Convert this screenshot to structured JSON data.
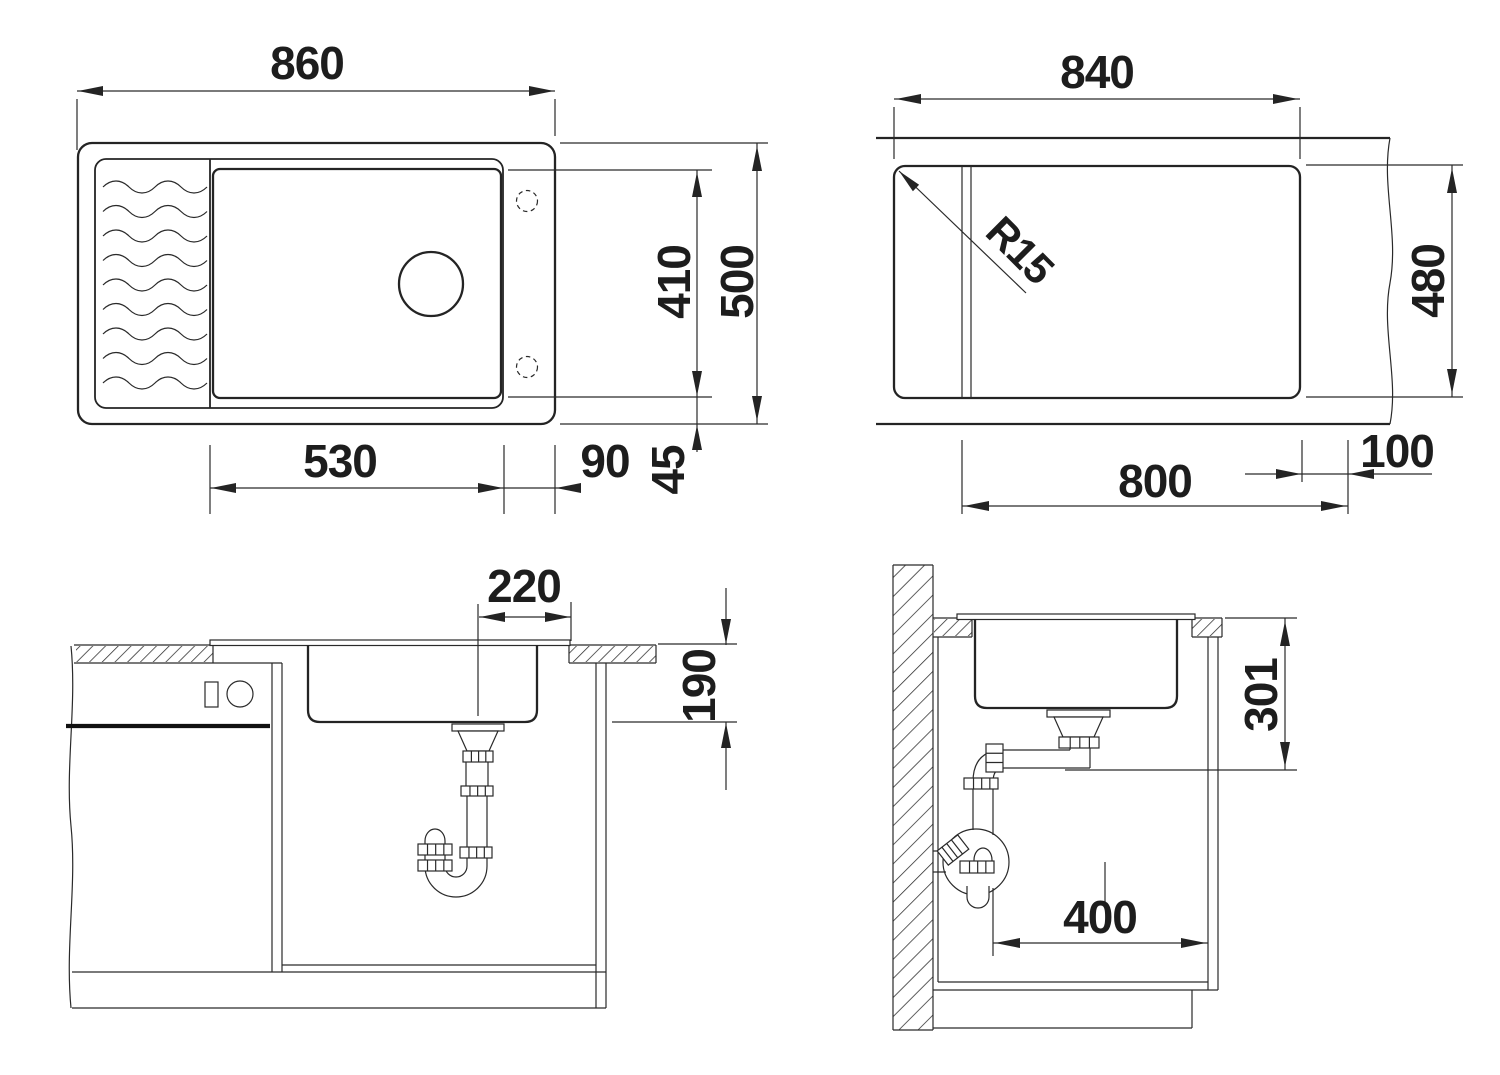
{
  "drawing": {
    "type": "sink-installation-dimensions",
    "colors": {
      "line": "#242424",
      "background": "#ffffff",
      "text": "#1d1d1d"
    }
  },
  "views": {
    "plan": {
      "title": "sink-top-view",
      "dims": {
        "overall_width": "860",
        "inner_depth": "410",
        "overall_depth": "500",
        "bowl_width": "530",
        "right_margin": "90",
        "bottom_margin": "45"
      }
    },
    "cutout": {
      "title": "countertop-cutout-view",
      "dims": {
        "width": "840",
        "corner_radius": "R15",
        "depth": "480",
        "lower_width": "800",
        "edge_offset": "100"
      }
    },
    "front": {
      "title": "front-section-view",
      "dims": {
        "drain_offset": "220",
        "bowl_depth": "190"
      }
    },
    "side": {
      "title": "side-section-view",
      "dims": {
        "outlet_height": "301",
        "wall_clearance": "400"
      }
    }
  }
}
